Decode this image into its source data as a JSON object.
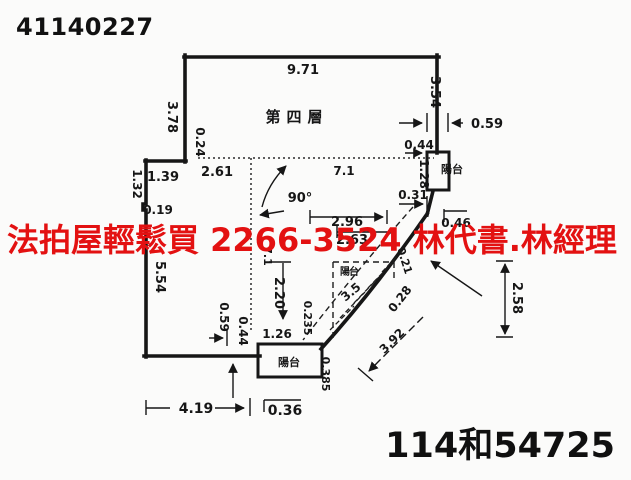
{
  "page": {
    "doc_number": "41140227",
    "case_number": "114和54725",
    "watermark": {
      "text": "法拍屋輕鬆買  2266-3524  林代書.林經理",
      "color": "#e31111"
    },
    "ink_color": "#161616",
    "background_color": "#fbfbfa"
  },
  "plan": {
    "floor_label": "第四層",
    "angle_label": "90°",
    "balcony_label_right": "陽台",
    "balcony_label_arc": "陽台",
    "balcony_label_bottom": "陽台",
    "dims": {
      "top_width": "9.71",
      "left_upper": "3.78",
      "left_inset": "0.24",
      "left_step_v": "1.32",
      "left_step_h": "1.39",
      "step_width": "2.61",
      "left_small": "0.19",
      "left_lower": "5.54",
      "interior_width": "7.1",
      "interior_height": "7.1",
      "right_upper": "3.54",
      "right_offset": "0.59",
      "balcony_top_offset": "0.44",
      "balcony_right_height": "1.28",
      "balcony_bottom_offset": "0.31",
      "upper_mid_width": "2.96",
      "right_bracket": "0.46",
      "lower_mid_width": "2.63",
      "arc_upper": "0.21",
      "arc_inner": "3.5",
      "arc_mid": "0.28",
      "arc_outer": "3.92",
      "arc_chord_height": "2.58",
      "room_height": "2.20",
      "room_offset": "0.235",
      "balcony_bottom_width": "1.26",
      "bottom_left_offset": "0.59",
      "bottom_mid_offset": "0.44",
      "balcony_bottom_height": "0.385",
      "bottom_width": "4.19",
      "bottom_small": "0.36"
    }
  }
}
